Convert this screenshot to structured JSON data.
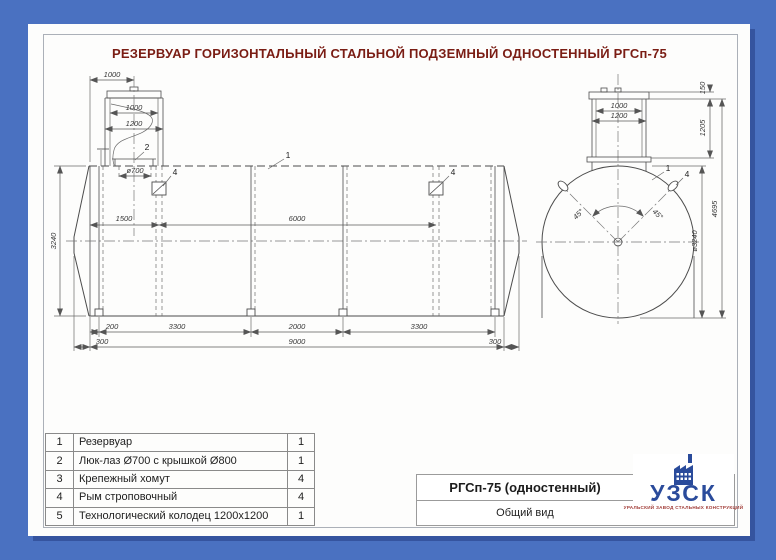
{
  "page": {
    "title": "РЕЗЕРВУАР ГОРИЗОНТАЛЬНЫЙ СТАЛЬНОЙ ПОДЗЕМНЫЙ ОДНОСТЕННЫЙ РГСп-75"
  },
  "side_view": {
    "callout_tank": "1",
    "callout_manhole": "2",
    "callout_eye_left": "4",
    "callout_eye_right": "4",
    "dim_neck_offset": "1000",
    "dim_well_inner": "1000",
    "dim_well_outer": "1200",
    "dim_manhole": "ø700",
    "dim_eye_left": "1500",
    "dim_eye_spacing": "6000",
    "dim_height": "3240",
    "dim_support_end": "200",
    "dim_support_span_1": "3300",
    "dim_support_mid": "2000",
    "dim_support_span_2": "3300",
    "dim_overhang_left": "300",
    "dim_body_length": "9000",
    "dim_overhang_right": "300"
  },
  "end_view": {
    "callout_tank": "1",
    "callout_eye": "4",
    "dim_lid_height": "150",
    "dim_well_inner": "1000",
    "dim_well_outer": "1200",
    "dim_neck_height": "1205",
    "dim_total_height": "4695",
    "dim_diameter": "ø3240",
    "dim_angle_left": "45°",
    "dim_angle_right": "45°"
  },
  "parts_table": {
    "rows": [
      {
        "num": "1",
        "name": "Резервуар",
        "qty": "1"
      },
      {
        "num": "2",
        "name": "Люк-лаз Ø700 с крышкой Ø800",
        "qty": "1"
      },
      {
        "num": "3",
        "name": "Крепежный хомут",
        "qty": "4"
      },
      {
        "num": "4",
        "name": "Рым строповочный",
        "qty": "4"
      },
      {
        "num": "5",
        "name": "Технологический колодец 1200х1200",
        "qty": "1"
      }
    ]
  },
  "title_block": {
    "product": "РГСп-75 (одностенный)",
    "caption": "Общий вид"
  },
  "logo": {
    "abbr": "УЗСК",
    "full_name": "УРАЛЬСКИЙ ЗАВОД СТАЛЬНЫХ КОНСТРУКЦИЙ"
  },
  "colors": {
    "background": "#4a71c1",
    "title_red": "#7a1d14",
    "logo_blue": "#2a4b9b",
    "logo_sub_red": "#a03a35"
  }
}
